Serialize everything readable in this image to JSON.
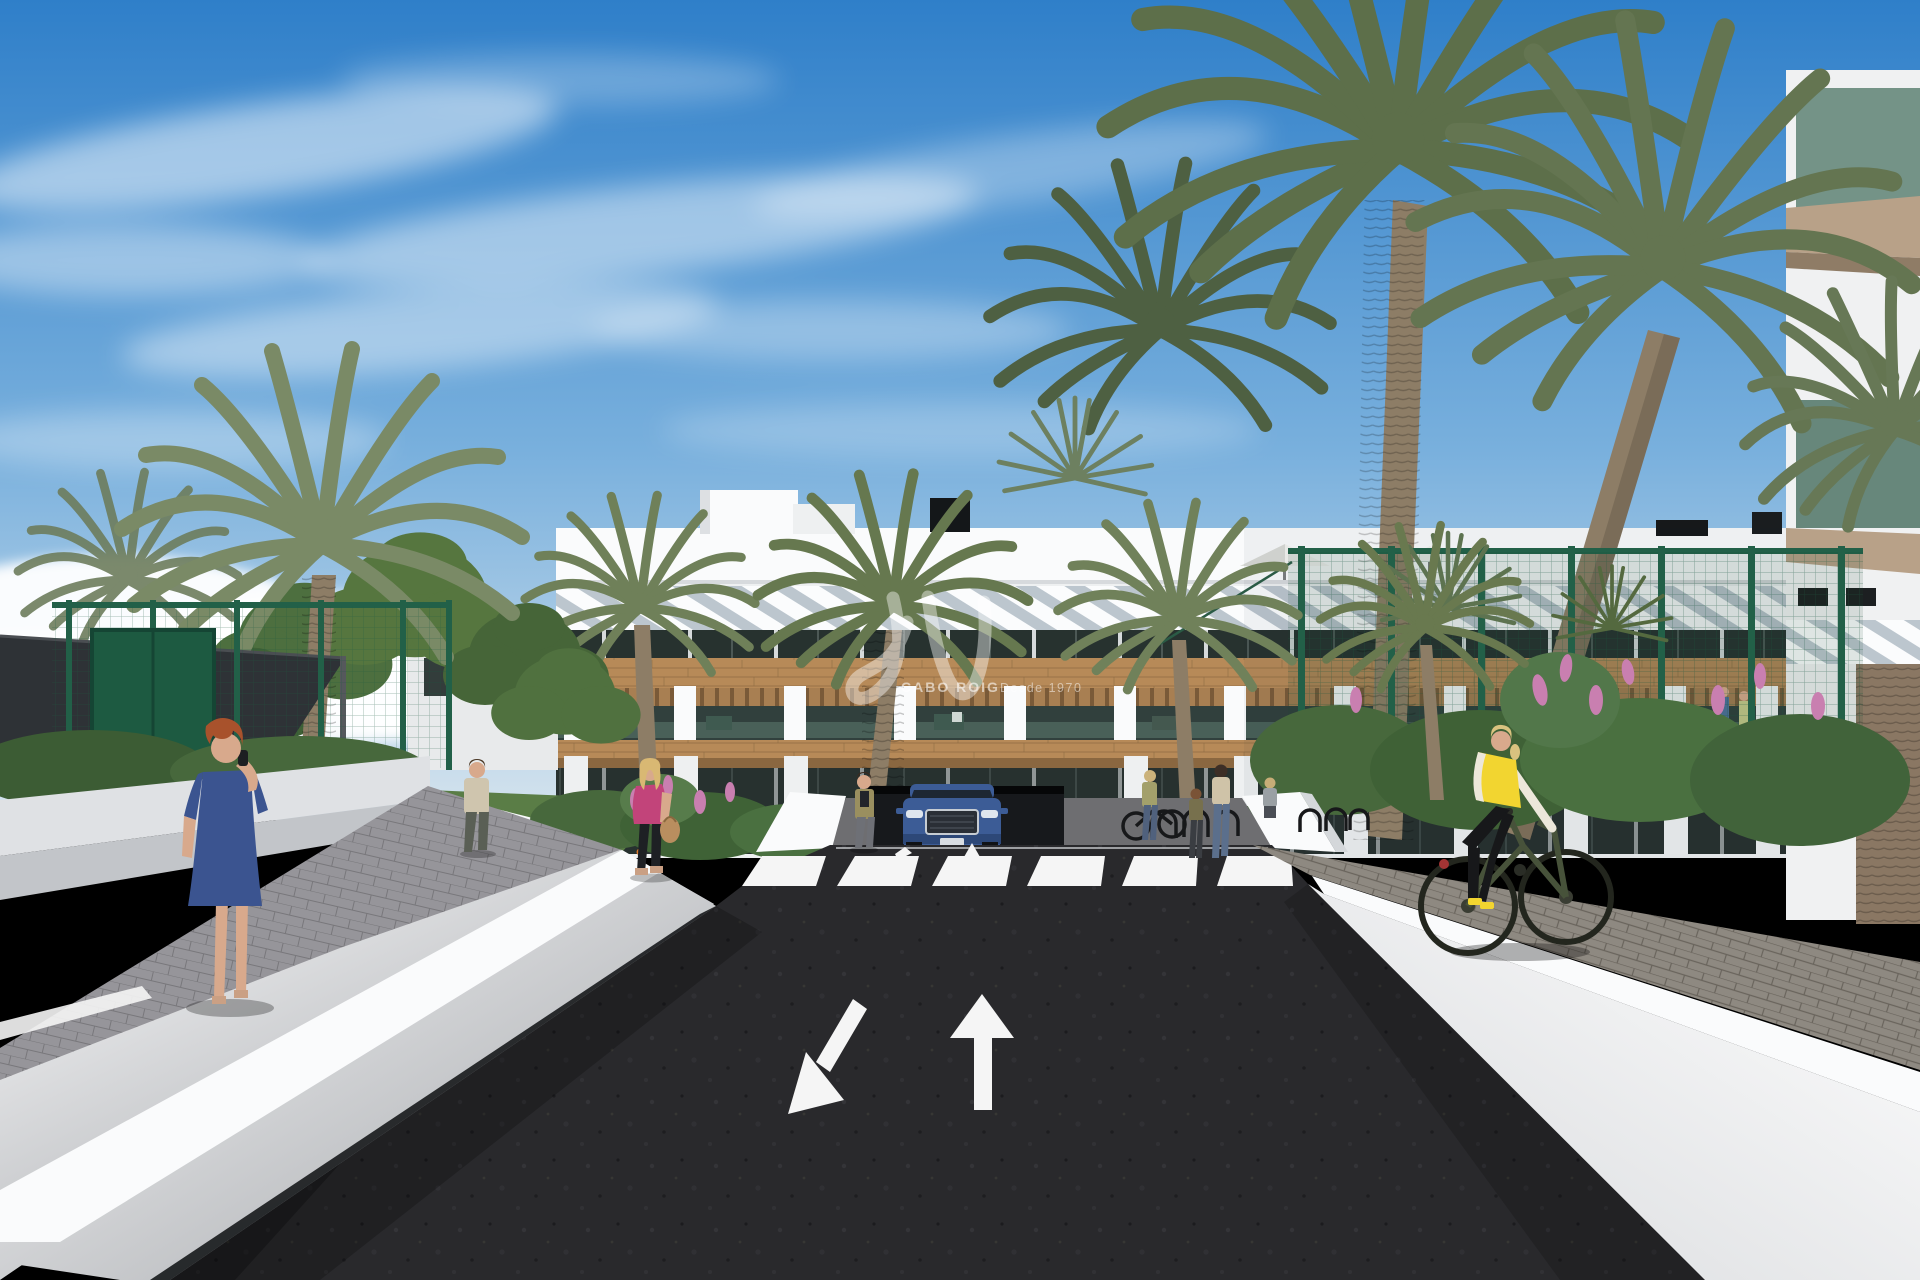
{
  "scene": {
    "type": "3d-architectural-render",
    "subject": "Street-level view of a new-build white apartment complex with palm trees, entrance road, crosswalk, pedestrians and a cyclist"
  },
  "watermark": {
    "brand": "CABO ROIG",
    "tagline": "Desde 1970",
    "monogram_icon": "script-monogram-icon"
  },
  "road_markings": {
    "left_lane_arrow": "arrow pointing down-left (oncoming lane)",
    "right_lane_arrow": "arrow pointing straight ahead (outgoing lane)",
    "crosswalk_stripes": 6
  },
  "colors": {
    "sky-top": "#2f7fc9",
    "sky-mid": "#79b0dd",
    "sky-horizon": "#d6e4ee",
    "cloud": "#ffffff",
    "wall-white": "#eef0f1",
    "wall-bright": "#fafbfc",
    "wall-shade": "#c9ccd0",
    "wood": "#b78a58",
    "wood-dark": "#8a6740",
    "glass-dark": "#2e3a3a",
    "asphalt": "#29292c",
    "pavers-left": "#96959a",
    "pavers-right": "#8e8981",
    "grass": "#5a7d46",
    "tree-green": "#4d6f3f",
    "palm-green": "#6f8059",
    "fence-green": "#226048",
    "gate-green": "#1d5a41",
    "flower-orange": "#d9772c",
    "flower-pink": "#c97fb0",
    "car-blue": "#3c5c96",
    "vest-yellow": "#f2d530",
    "dress-blue": "#3b5490",
    "jacket-pink": "#c2447a",
    "marking-white": "#f5f5f5",
    "skin": "#d8a98c",
    "sail-dark": "#2e3236",
    "trunk": "#8d7d66"
  }
}
